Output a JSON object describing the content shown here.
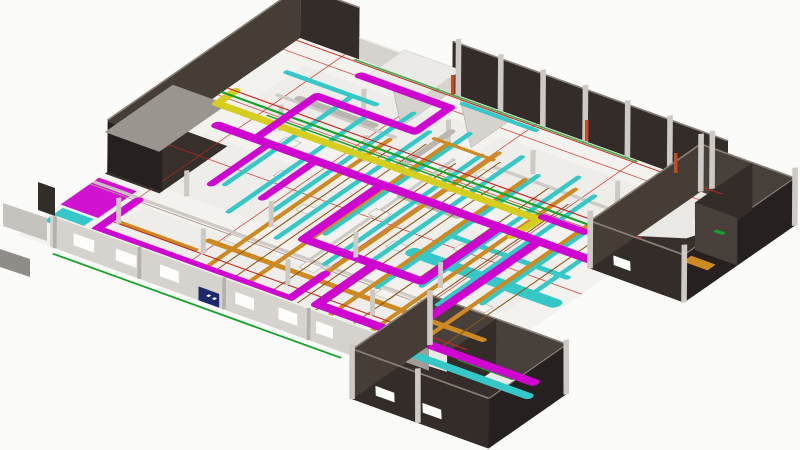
{
  "scene": {
    "type": "3d-bim-model-view",
    "label": "Isometric 3D BIM view of a building floor plate with color-coded MEP services: magenta supply ductwork, cyan return ducts, orange cable trays, yellow exhaust duct, green and red piping, dark perimeter room walls, light front walls with windows and a blue door, and gray structural columns on a white floor slab with red grid lines",
    "background": "#fbfbfa"
  },
  "viewport": {
    "width": 800,
    "height": 450
  },
  "colors": {
    "bg": "#fbfbfa",
    "floor": "#f3f2ef",
    "floor_panel": "#eceae6",
    "floor_dark": "#372f2b",
    "floor_light": "#eae8e4",
    "wall_dark": "#332c28",
    "wall_dark2": "#453d36",
    "wall_darkest": "#262120",
    "wall_mid": "#48403a",
    "wall_cap": "#8a8179",
    "wall_light": "#d6d3cf",
    "wall_light_cap": "#f0efec",
    "roof": "#9a958f",
    "column": "#cdcac5",
    "magenta": "#cf06cf",
    "cyan": "#35c8c6",
    "orange": "#cd8a22",
    "conduit": "#8a5718",
    "yellow": "#d6ce1f",
    "green": "#18a12c",
    "red": "#c3281e",
    "navy": "#1c2a6d",
    "gray_duct": "#b9b6b0"
  },
  "systems": [
    {
      "id": "supply-air-ducts",
      "color_key": "magenta"
    },
    {
      "id": "return-extract-ducts",
      "color_key": "cyan"
    },
    {
      "id": "cable-trays",
      "color_key": "orange"
    },
    {
      "id": "electrical-conduits",
      "color_key": "conduit"
    },
    {
      "id": "exhaust-duct",
      "color_key": "yellow"
    },
    {
      "id": "mechanical-piping",
      "color_key": "green"
    },
    {
      "id": "fire-piping-gridlines",
      "color_key": "red"
    },
    {
      "id": "shell-walls",
      "color_key": "wall_dark"
    },
    {
      "id": "partition-walls",
      "color_key": "wall_light"
    },
    {
      "id": "structural-columns",
      "color_key": "column"
    },
    {
      "id": "entry-door",
      "color_key": "navy"
    }
  ]
}
